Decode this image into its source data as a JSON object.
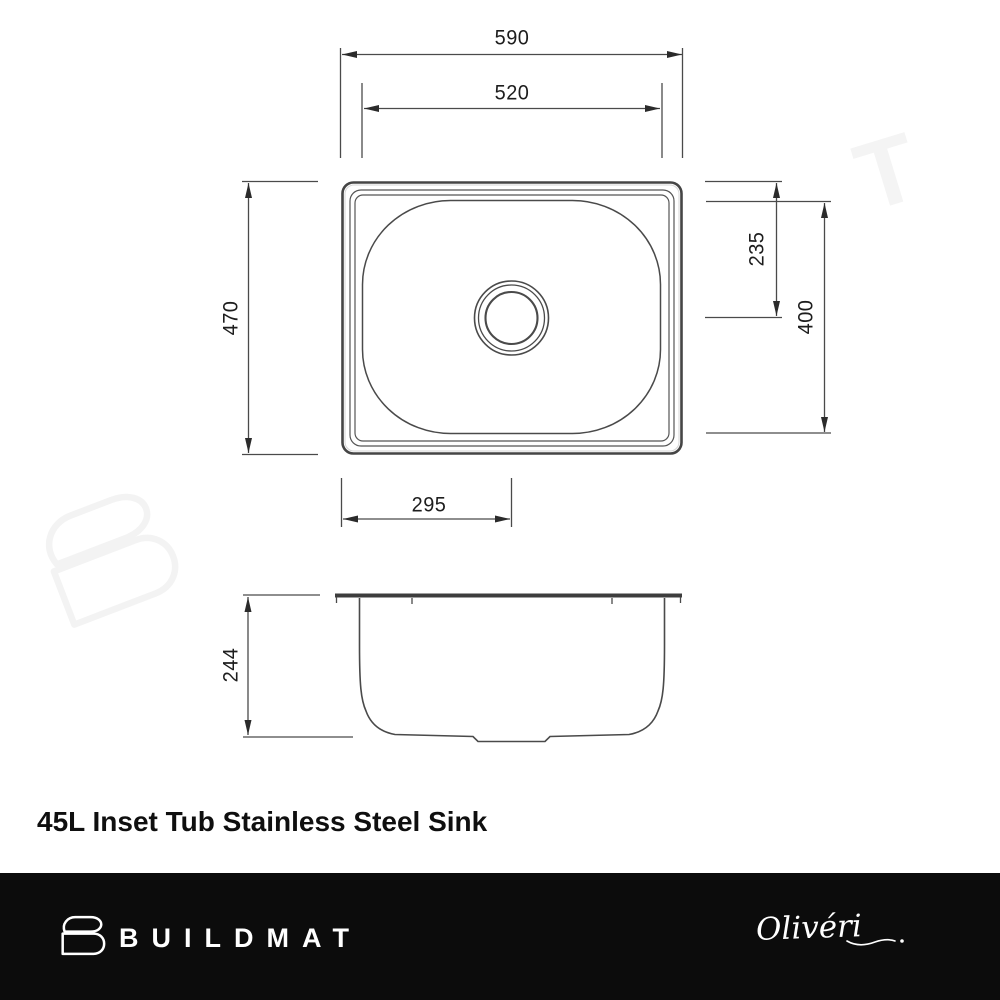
{
  "title": "45L Inset Tub Stainless Steel Sink",
  "diagram": {
    "units": "mm",
    "top_view": {
      "overall_width": "590",
      "bowl_rim_width": "520",
      "overall_depth": "470",
      "drain_center_from_top_edge": "235",
      "bowl_inner_depth": "400",
      "drain_center_from_left_edge": "295"
    },
    "side_view": {
      "bowl_depth": "244"
    }
  },
  "watermark": {
    "letter_t": "T",
    "logo": "buildmat-b-mark"
  },
  "footer": {
    "brand": "BUILDMAT",
    "brand_logo": "buildmat-b-mark",
    "manufacturer_signature": "Olivéri"
  },
  "colors": {
    "drawing_line": "#4a4a4a",
    "arrow_fill": "#2b2b2b",
    "footer_background": "#0c0c0c",
    "watermark": "#f3f3f3",
    "text": "#1d1d1d"
  }
}
